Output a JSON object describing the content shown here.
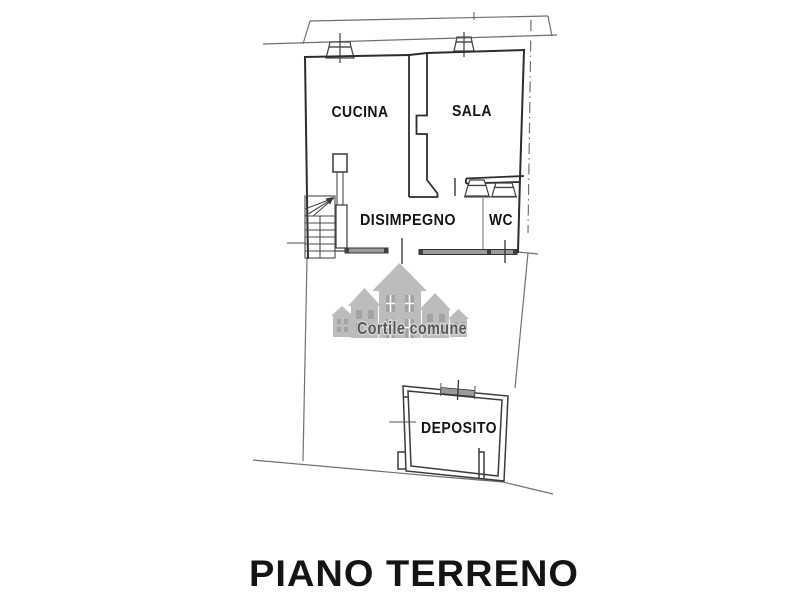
{
  "plan": {
    "title": "PIANO TERRENO",
    "watermark_text": "Cortile comune",
    "rooms": {
      "cucina": "CUCINA",
      "sala": "SALA",
      "disimpegno": "DISIMPEGNO",
      "wc": "WC",
      "deposito": "DEPOSITO"
    },
    "colors": {
      "background": "#ffffff",
      "wall_line": "#2d2d2d",
      "thin_boundary_line": "#707070",
      "wall_fill_gray": "#9a9a9a",
      "watermark_houses_gray": "#b7b7b7",
      "watermark_windows_gray": "#9c9c9c",
      "watermark_text_gray": "#4a4a4a",
      "label_black": "#141414"
    }
  }
}
